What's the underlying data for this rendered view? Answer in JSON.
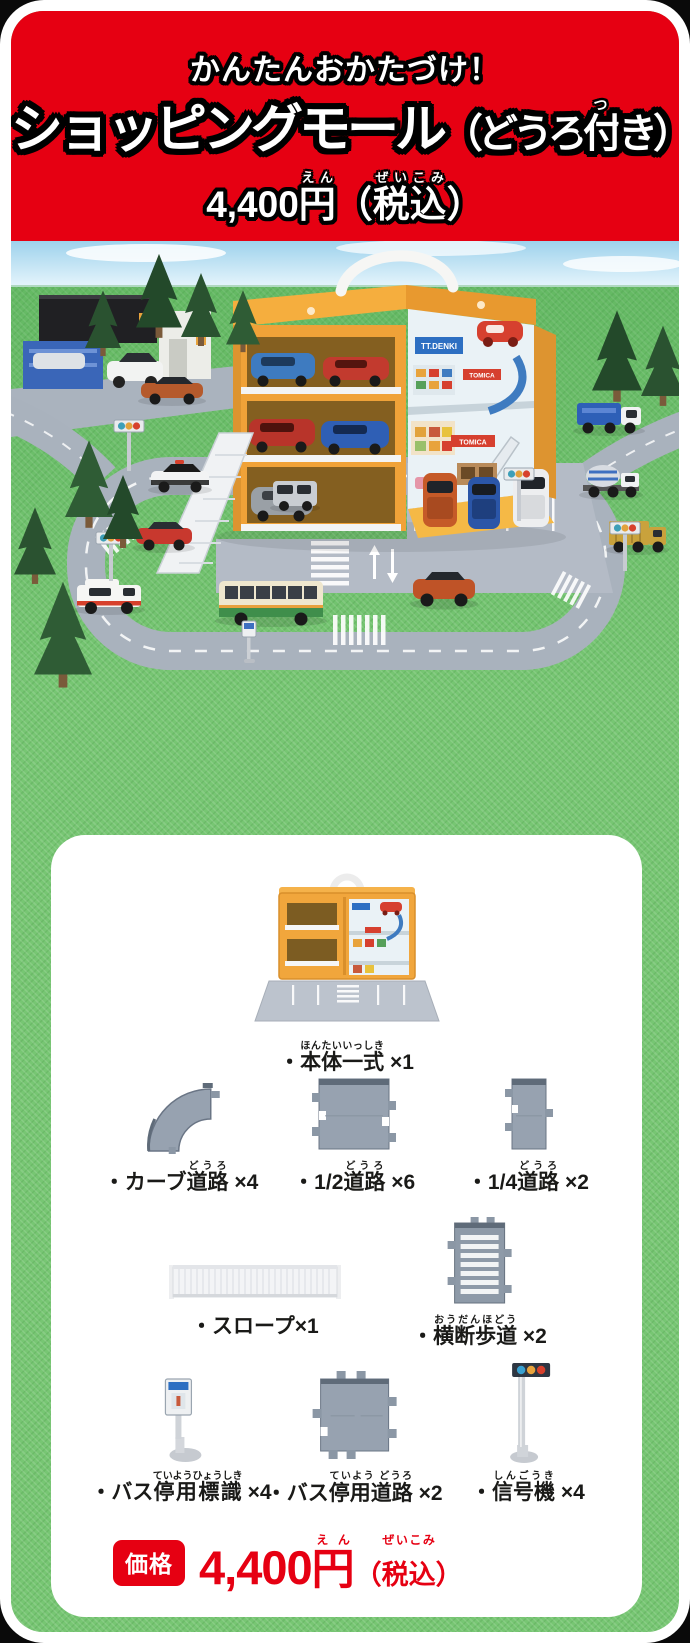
{
  "theme": {
    "brand_red": "#e60012",
    "background_green": "#77c673",
    "card_white": "#ffffff",
    "road_gray": "#97a2b0",
    "case_yellow": "#f0a238"
  },
  "header": {
    "tagline": "かんたんおかたづけ！",
    "title_main": "ショッピングモール",
    "title_paren_pre": "（どうろ",
    "title_furigana_base": "付",
    "title_furigana": "つ",
    "title_paren_post": "き）",
    "price_amount": "4,400",
    "price_yen": "円",
    "price_yen_furigana": "えん",
    "price_tax_open": "（",
    "price_tax": "税込",
    "price_tax_furigana": "ぜいこみ",
    "price_tax_close": "）"
  },
  "photo": {
    "signs": {
      "tt_denki": "TT.DENKI",
      "tomica_1": "TOMICA",
      "tomica_2": "TOMICA"
    }
  },
  "parts": {
    "items": [
      {
        "id": "main-set",
        "prefix": "・",
        "ruby_base": "本体一式",
        "ruby": "ほんたいいっしき",
        "count": " ×1"
      },
      {
        "id": "curve-road",
        "prefix": "・カーブ",
        "ruby_base": "道路",
        "ruby": "どうろ",
        "count": " ×4"
      },
      {
        "id": "half-road",
        "prefix": "・1/2",
        "ruby_base": "道路",
        "ruby": "どうろ",
        "count": " ×6"
      },
      {
        "id": "quarter-road",
        "prefix": "・1/4",
        "ruby_base": "道路",
        "ruby": "どうろ",
        "count": " ×2"
      },
      {
        "id": "slope",
        "prefix": "・スロープ",
        "ruby_base": "",
        "ruby": "",
        "count": "×1"
      },
      {
        "id": "crosswalk",
        "prefix": "・",
        "ruby_base": "横断歩道",
        "ruby": "おうだんほどう",
        "count": " ×2"
      },
      {
        "id": "bus-stop-sign",
        "prefix": "・バス",
        "ruby_base": "停用標識",
        "ruby": "ていようひょうしき",
        "count": " ×4"
      },
      {
        "id": "bus-stop-road",
        "prefix": "・バス",
        "ruby_base": "停用道路",
        "ruby": "ていよう どうろ",
        "count": " ×2"
      },
      {
        "id": "traffic-signal",
        "prefix": "・",
        "ruby_base": "信号機",
        "ruby": "しんごうき",
        "count": " ×4"
      }
    ]
  },
  "footer": {
    "badge": "価格",
    "price_amount": "4,400",
    "price_yen": "円",
    "price_yen_furigana": "えん",
    "tax_open": "（",
    "price_tax": "税込",
    "price_tax_furigana": "ぜいこみ",
    "tax_close": "）"
  }
}
